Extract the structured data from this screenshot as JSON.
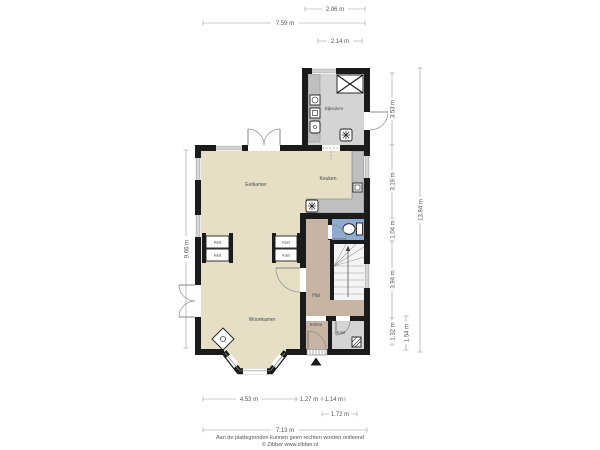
{
  "rooms": {
    "bijkeuken": "Bijkeuken",
    "keuken": "Keuken",
    "eetkamer": "Eetkamer",
    "woonkamer": "Woonkamer",
    "hal": "Hal",
    "entree": "Entree",
    "kast": "Kast"
  },
  "closets": {
    "label": "Kast"
  },
  "dimensions": {
    "top": [
      "2.96 m",
      "7.59 m",
      "2.14 m"
    ],
    "bottom": [
      "4.53 m",
      "1.27 m",
      "1.14 m",
      "1.72 m",
      "7.13 m"
    ],
    "left": [
      "9.66 m"
    ],
    "right": [
      "3.53 m",
      "3.19 m",
      "1.04 m",
      "3.94 m",
      "1.32 m",
      "1.54 m",
      "13.84 m"
    ]
  },
  "footer": {
    "disclaimer": "Aan de plattegronden kunnen geen rechten worden ontleend",
    "copyright": "© Zibber www.zibber.nl"
  },
  "icons": {
    "roof_window": "crossed-box-icon",
    "sink": "sink-asterisk-icon",
    "toilet": "toilet-icon",
    "stove": "wood-stove-icon",
    "stairs": "winder-stairs",
    "entrance_marker": "entrance-triangle-icon",
    "doormat": "doormat-icon",
    "appliances": "appliance-icons",
    "meter_box": "meter-box-icon"
  },
  "colors": {
    "wall": "#1b1b1b",
    "floor_main": "#e6dfc6",
    "floor_utility": "#d4d4d4",
    "floor_hall": "#c7b5a3",
    "floor_toilet": "#8fabd0",
    "floor_stairs": "#f4f4f4",
    "counter": "#bfbfbf"
  }
}
